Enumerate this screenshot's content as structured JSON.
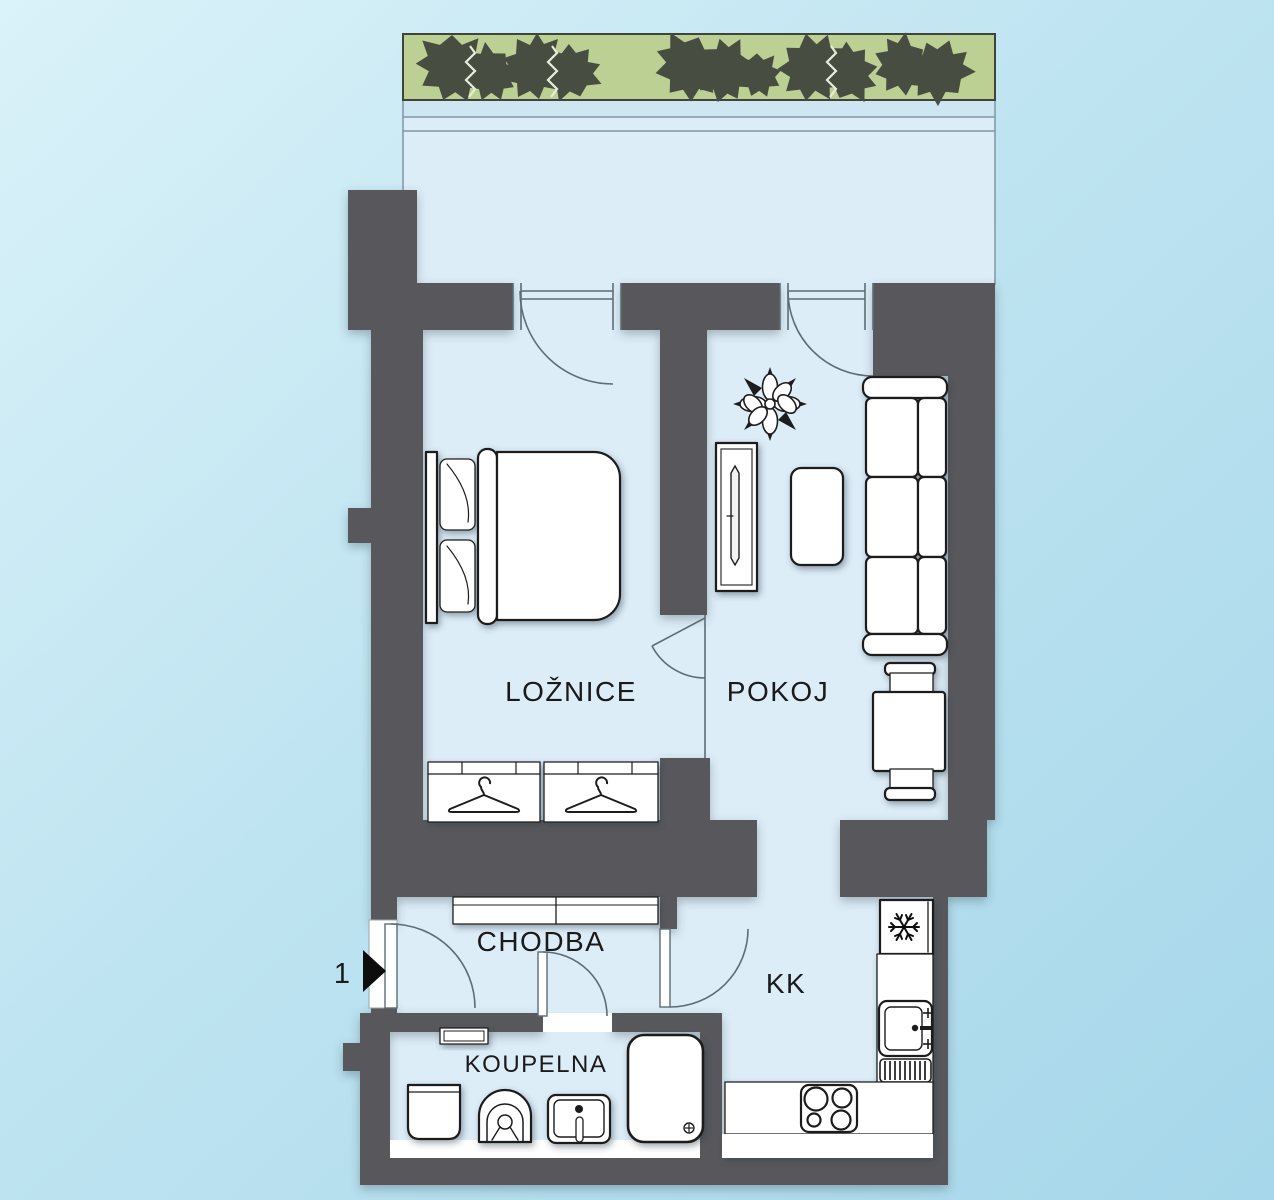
{
  "plan": {
    "type": "apartment-floor-plan",
    "entrance": {
      "number": "1"
    },
    "rooms": [
      {
        "id": "loznice",
        "label": "LOŽNICE"
      },
      {
        "id": "pokoj",
        "label": "POKOJ"
      },
      {
        "id": "chodba",
        "label": "CHODBA"
      },
      {
        "id": "kk",
        "label": "KK"
      },
      {
        "id": "koupelna",
        "label": "KOUPELNA"
      }
    ],
    "colors": {
      "background": "#bfe2ef",
      "floor": "#ddedf8",
      "wall": "#58595b",
      "greenery_strip": "#bcd093",
      "bush": "#484d42",
      "furniture_fill": "#ffffff",
      "furniture_outline": "#1d1d1f",
      "door_lines": "#5c6d75",
      "label_text": "#1a1a1a"
    },
    "icons": [
      "bush-icon",
      "flower-icon",
      "hanger-icon",
      "snowflake-icon",
      "burner-icon",
      "drain-icon",
      "faucet-icon",
      "entrance-arrow-icon"
    ],
    "furniture": [
      "double-bed",
      "wardrobe",
      "wardrobe",
      "tv-cabinet",
      "coffee-table",
      "sofa",
      "dining-table",
      "chair",
      "chair",
      "hall-closet",
      "fridge",
      "kitchen-counter",
      "kitchen-sink",
      "stove",
      "wall-shelf",
      "washing-machine",
      "toilet",
      "bathroom-sink",
      "shower"
    ]
  }
}
